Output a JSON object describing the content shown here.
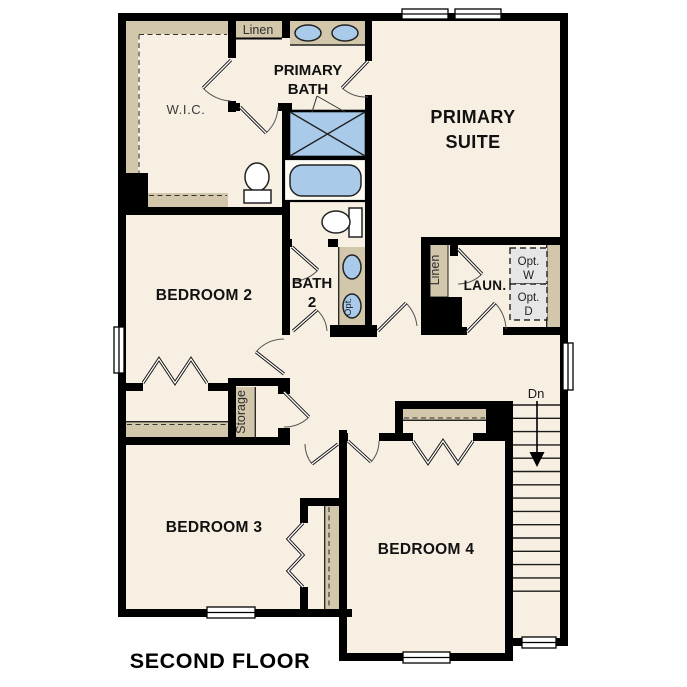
{
  "title": "SECOND FLOOR",
  "colors": {
    "wall": "#000000",
    "floor_cream": "#f7efe2",
    "closet_tan": "#d2c6ab",
    "fixture_blue": "#a9cbe9",
    "optional_gray": "#e6e6e6",
    "window_white": "#ffffff"
  },
  "rooms": {
    "wic": {
      "label": "W.I.C."
    },
    "linen_top": {
      "label": "Linen"
    },
    "primary_bath": {
      "line1": "PRIMARY",
      "line2": "BATH"
    },
    "primary_suite": {
      "line1": "PRIMARY",
      "line2": "SUITE"
    },
    "bedroom2": {
      "label": "BEDROOM 2"
    },
    "bath2": {
      "line1": "BATH",
      "line2": "2",
      "optional_sink_label": "Opt."
    },
    "laundry": {
      "label": "LAUN.",
      "linen_label": "Linen",
      "opt_washer_line1": "Opt.",
      "opt_washer_line2": "W",
      "opt_dryer_line1": "Opt.",
      "opt_dryer_line2": "D"
    },
    "storage": {
      "label": "Storage"
    },
    "stairs": {
      "label": "Dn"
    },
    "bedroom3": {
      "label": "BEDROOM 3"
    },
    "bedroom4": {
      "label": "BEDROOM 4"
    }
  }
}
